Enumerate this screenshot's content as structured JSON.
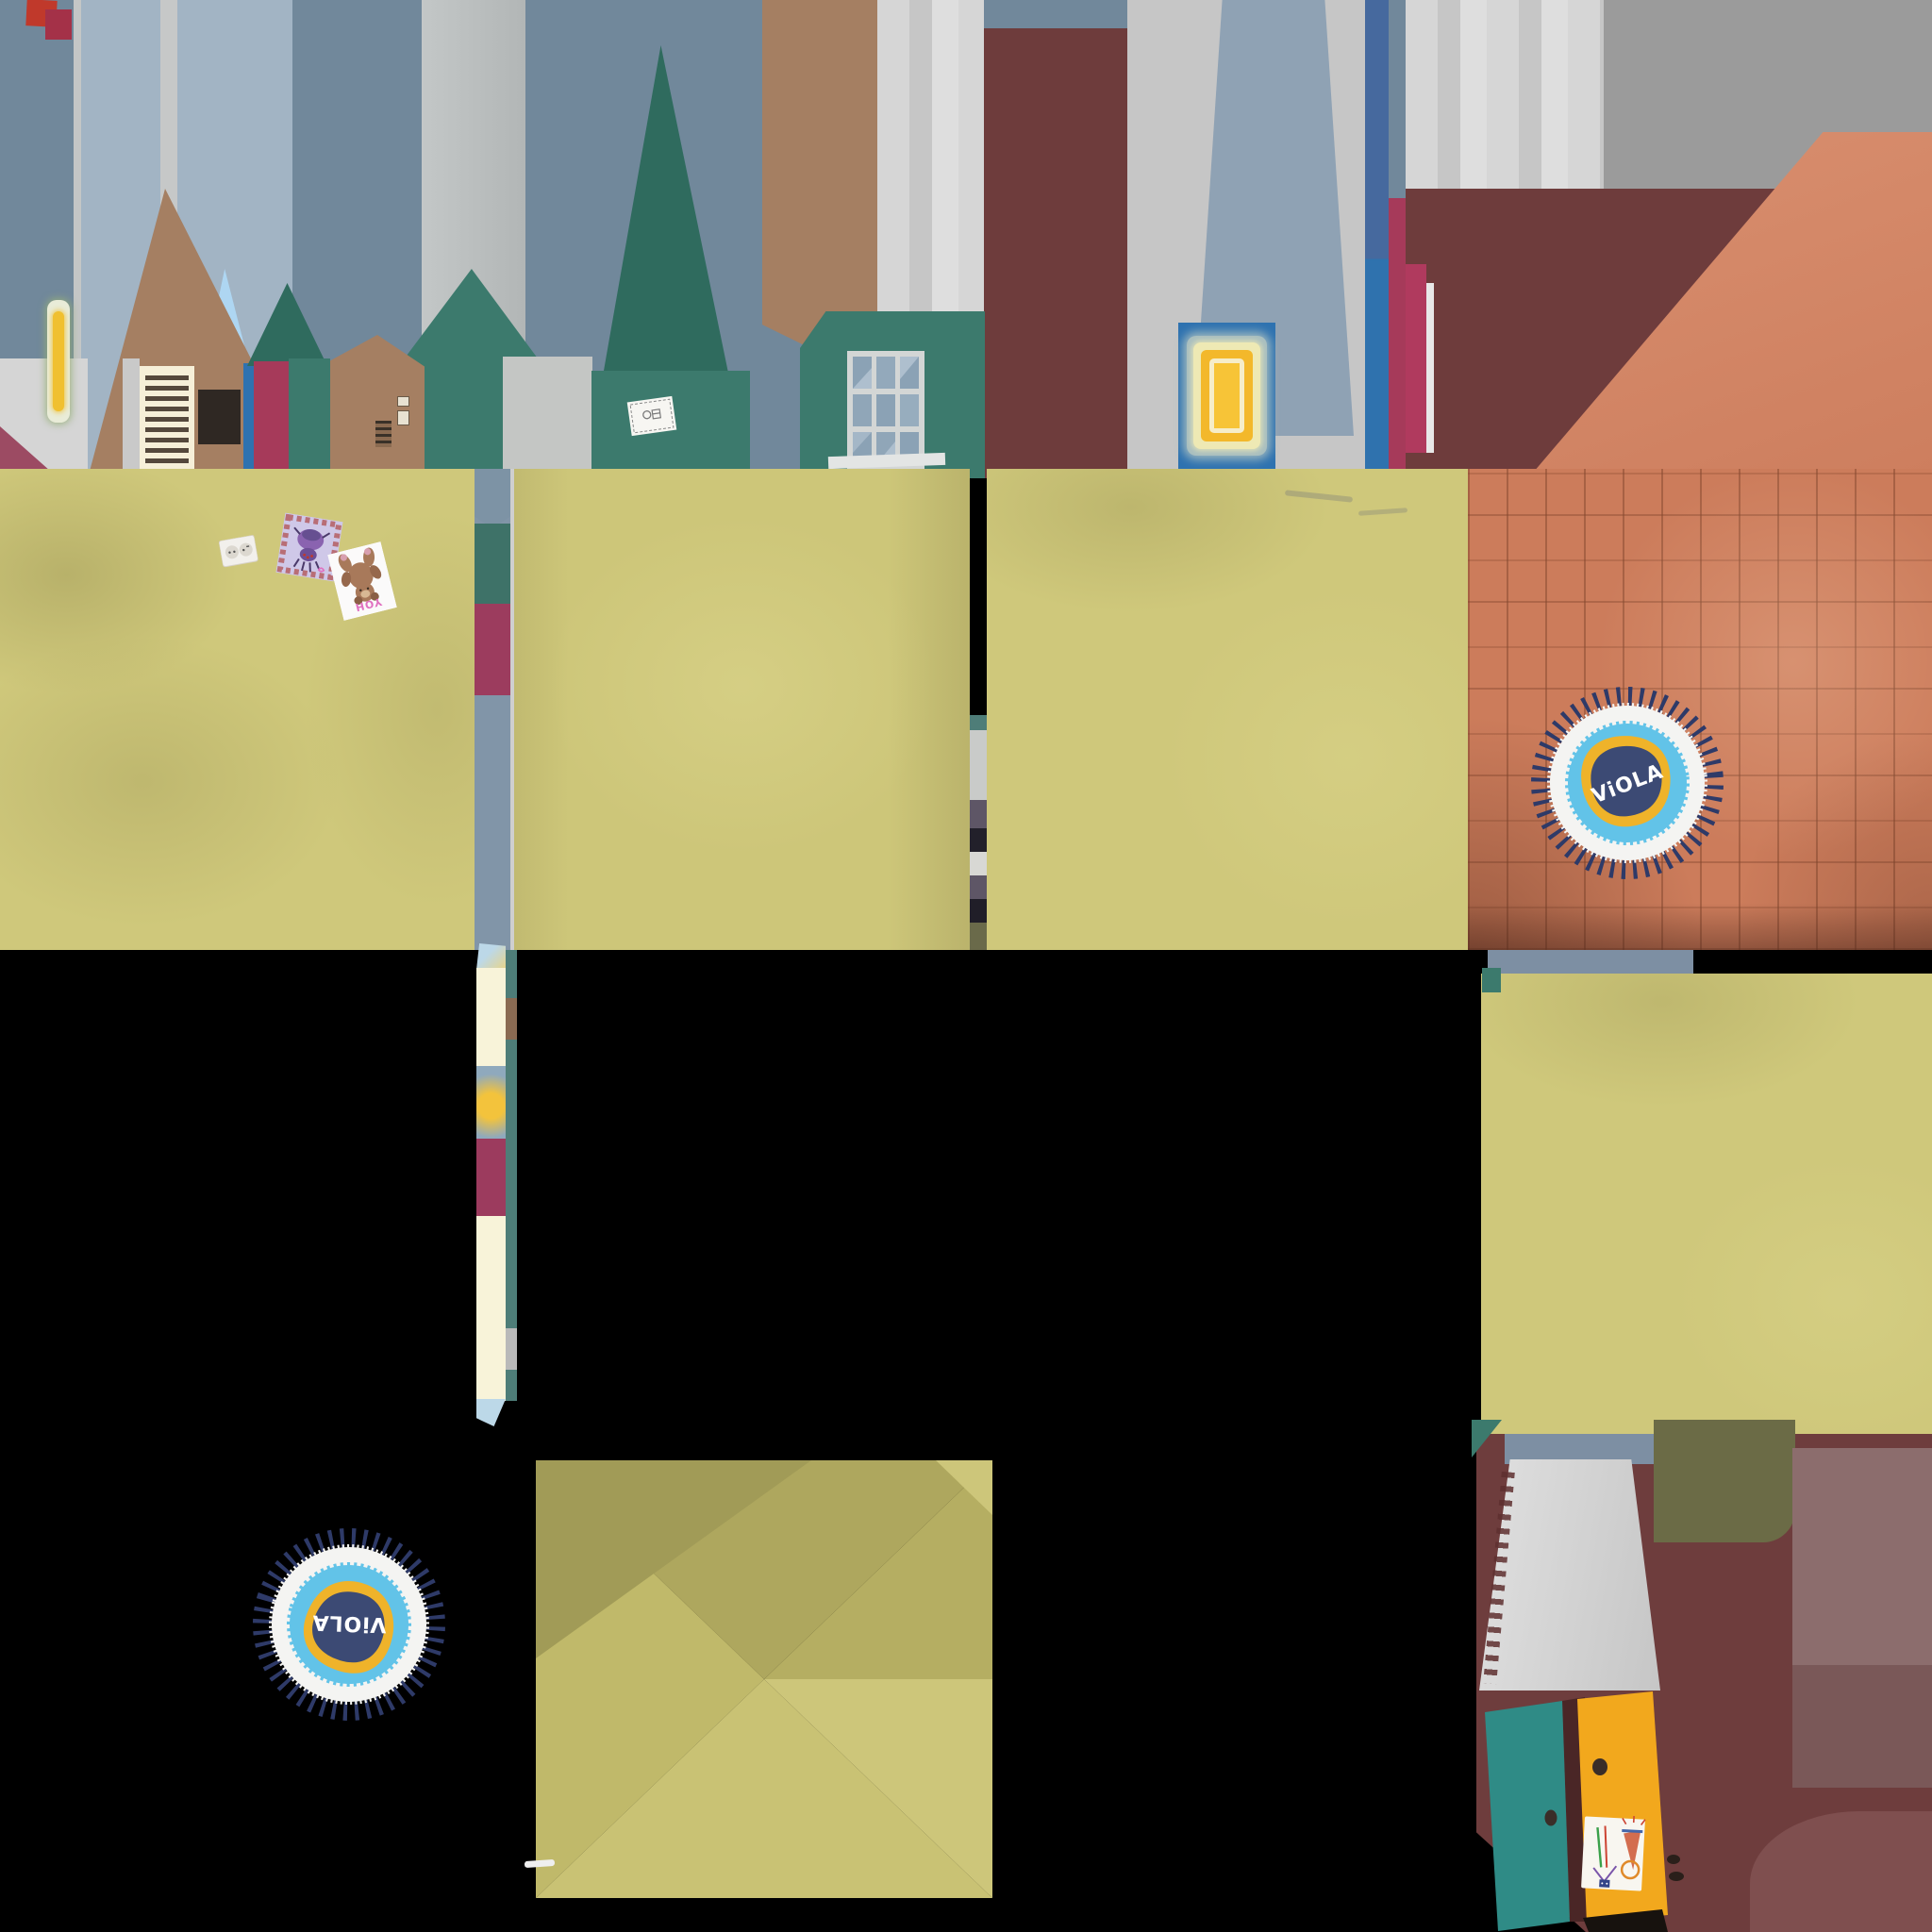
{
  "meta": {
    "kind": "game texture atlas sheet",
    "canvas": "2048x2048"
  },
  "labels": {
    "rug_text": "ViOLA",
    "bear_card_text": "YOH"
  },
  "palette": {
    "background": "#000000",
    "wall_blue_gray": "#71889b",
    "wall_light_blue": "#a2b4c4",
    "wall_pale_strip": "#c4c6c6",
    "curtain_white": "#d6d6d6",
    "curtain_dark_gray": "#9b9b9b",
    "curtain_blue": "#8fa2b4",
    "gable_brown": "#a57f62",
    "teal_wall": "#3c7a6d",
    "teal_spire": "#2f6b5e",
    "sky_blue": "#aed6f2",
    "crimson_door": "#a63a5a",
    "blue_door": "#2e72b0",
    "maroon_building": "#6e3c3c",
    "maroon_dark": "#6b3232",
    "terracotta": "#d28668",
    "brick": "#cc7c5b",
    "brick_seam": "#82462d",
    "floor_yellow": "#cfc87b",
    "floor_yellow_dark": "#aaa35d",
    "cream_strip": "#f8f3d9",
    "shutter_cream": "#f6efd8",
    "shutter_slat": "#55483c",
    "door_black": "#2f2823",
    "painting_outer": "#a9bfc0",
    "painting_pale": "#eee9b4",
    "painting_yellow": "#f3b82b",
    "painting_ring": "#f6edc9",
    "rug_center_navy": "#3c4a74",
    "rug_yellow": "#efb32a",
    "rug_cyan": "#62c3e8",
    "rug_white": "#f4f4f2",
    "rug_tassel": "#2e3a68",
    "wardrobe_teal": "#2f8b86",
    "wardrobe_yellow": "#f2a81d",
    "lampshade_gray": "#d6d6d6",
    "olive_patch": "#6b6b46",
    "mauve_patch": "#8c6d6d"
  },
  "inventory": {
    "facade_row": [
      "curtain walls",
      "brown gable house",
      "slatted shutter",
      "black door",
      "blue strip door",
      "crimson door",
      "teal gables",
      "nine-pane window",
      "blue door with yellow painting",
      "note card on teal wall",
      "small wall plaques",
      "vent grille"
    ],
    "floor_blocks": {
      "yellow_blocks": 4,
      "orange_brick_block": 1,
      "pinwheel_block": 1
    },
    "rugs": {
      "count": 2,
      "label": "ViOLA",
      "colors": {
        "center": "#3c4a74",
        "inner_ring": "#efb32a",
        "mid_ring": "#62c3e8",
        "outer_ring": "#f4f4f2",
        "tassels": "#2e3a68"
      }
    },
    "floor_stickers": {
      "power_outlet": true,
      "purple_creature_card": true,
      "bear_card_text": "YOH"
    },
    "furniture_corner": [
      "lampshade",
      "teal wardrobe door",
      "yellow wardrobe door with child drawing sticker",
      "black base strip"
    ]
  }
}
